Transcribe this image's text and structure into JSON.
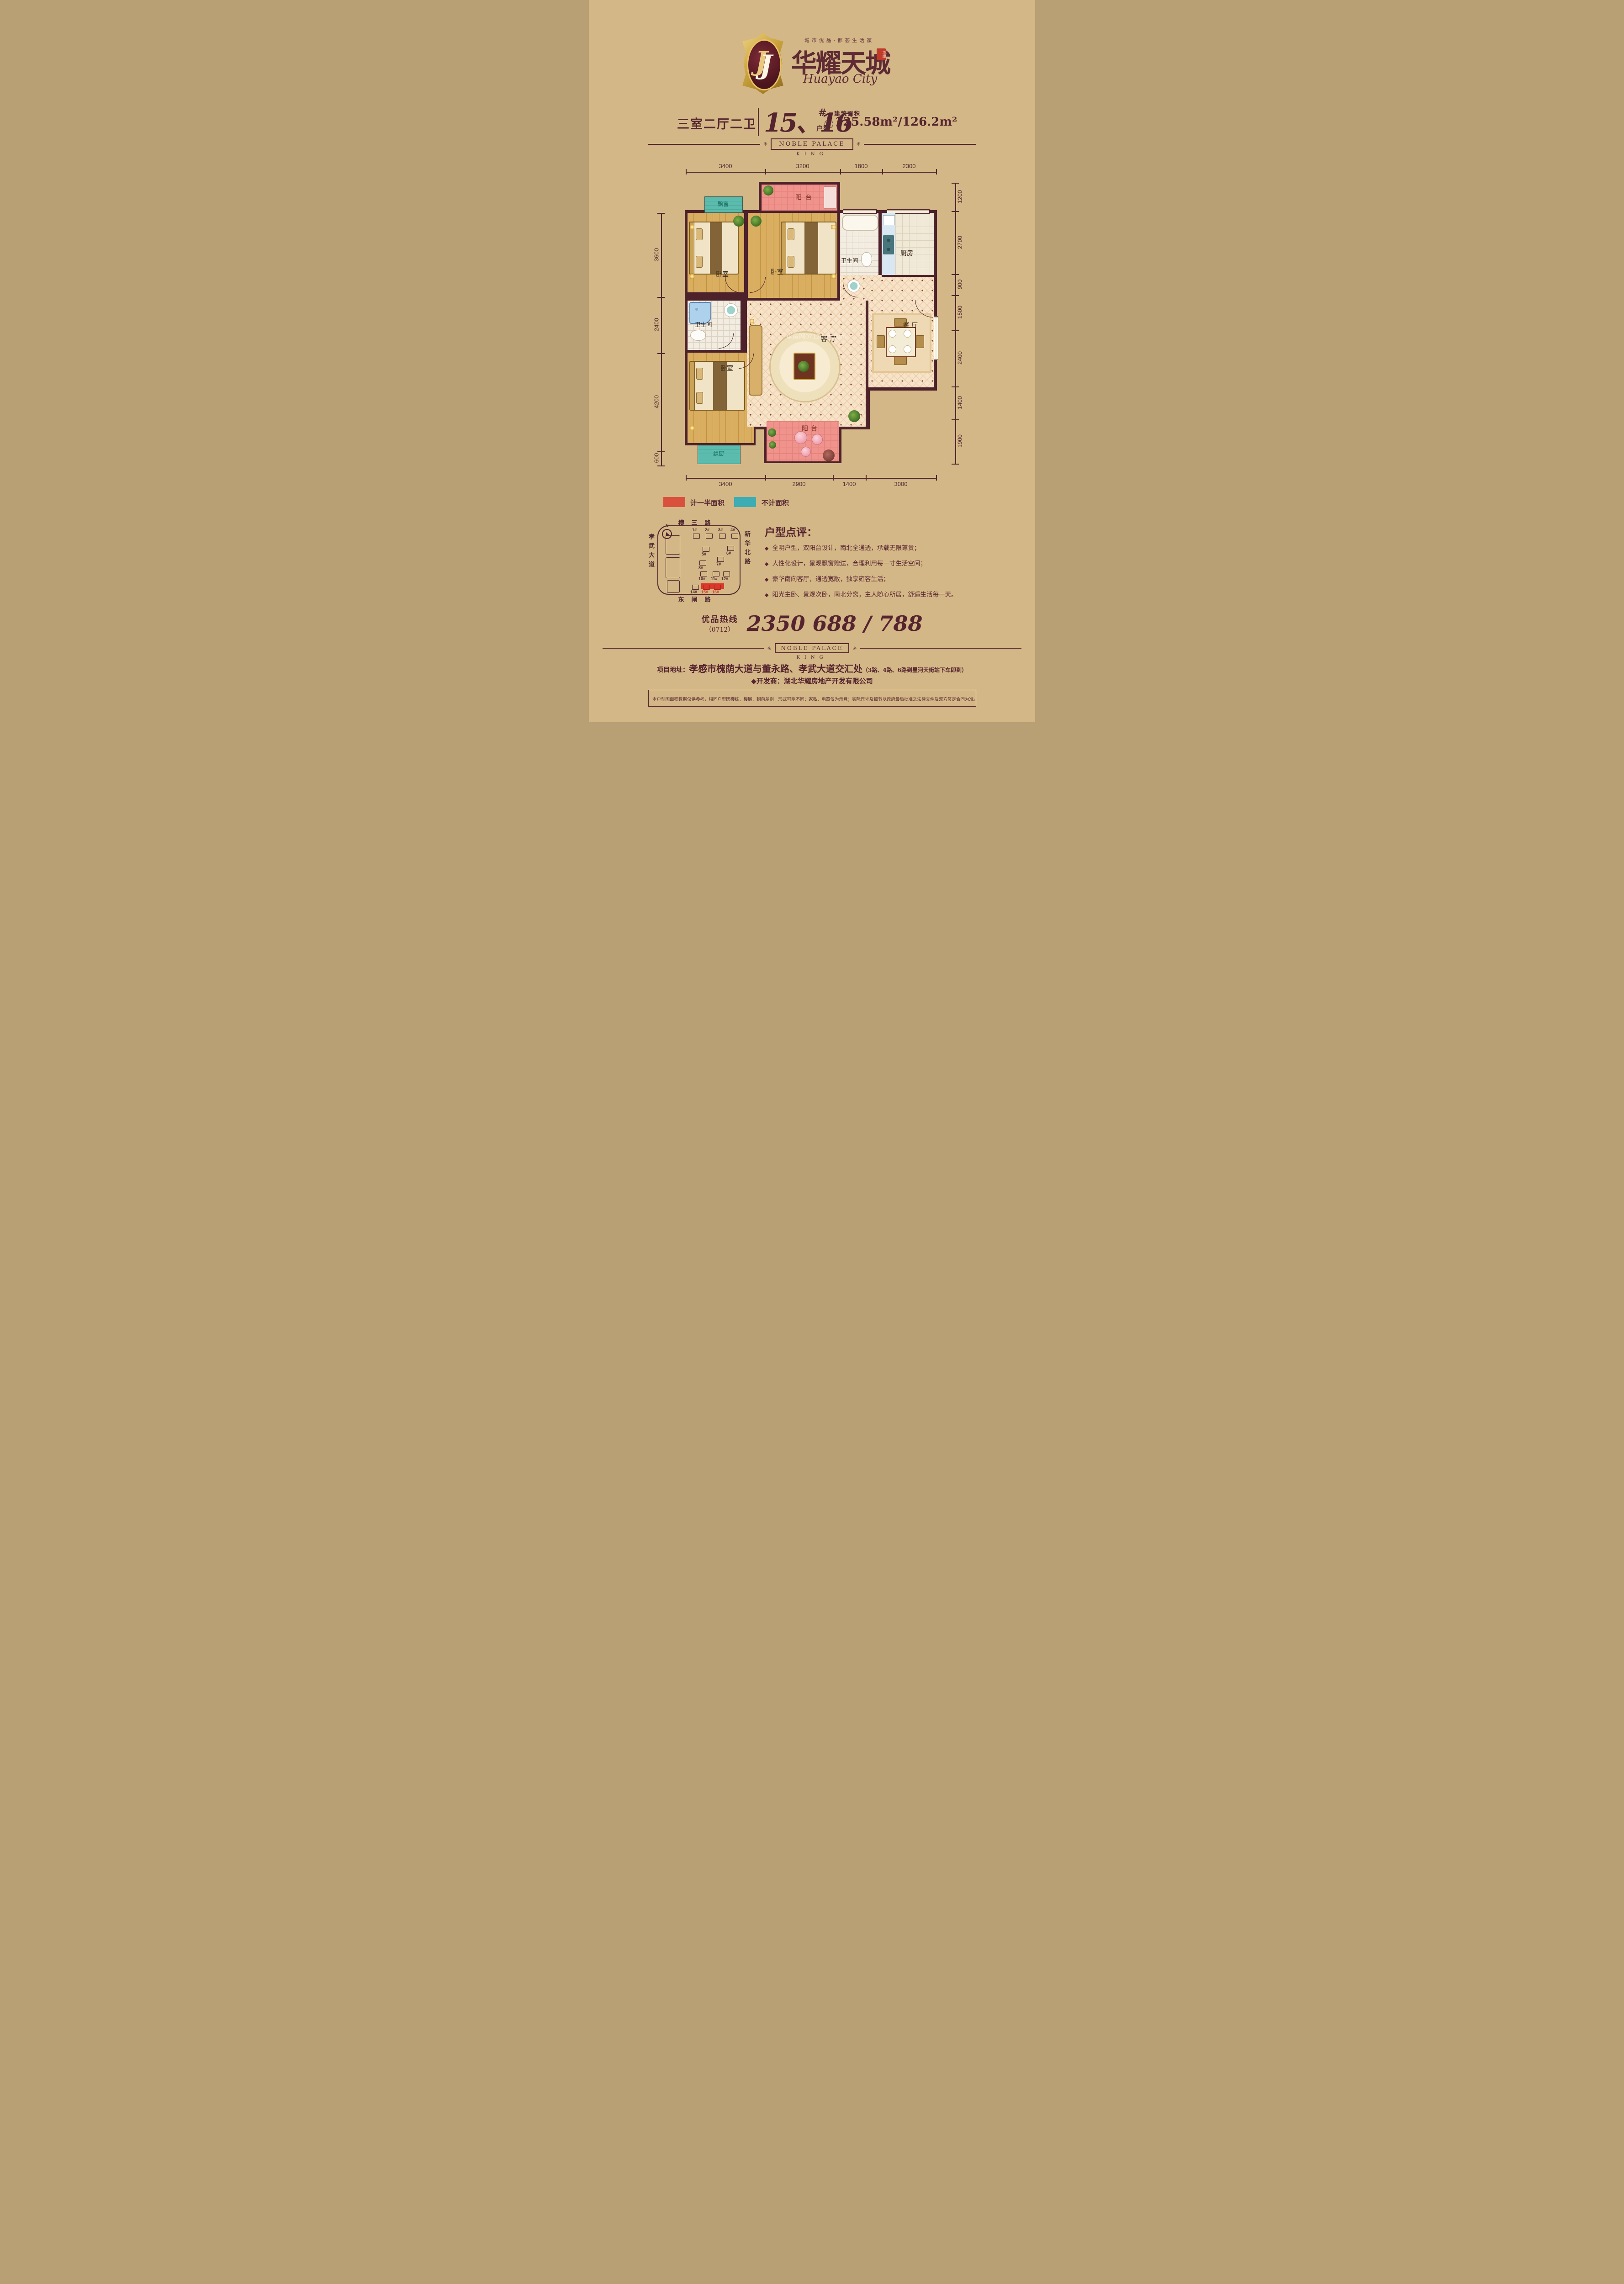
{
  "brand": {
    "tagline": "城市优品·都荟生活家",
    "name": "华耀天城",
    "name_en": "Huayao City",
    "seal_text": "华耀",
    "monogram": "J"
  },
  "title": {
    "rooms": "三室二厅二卫",
    "numbers": "15、16",
    "hash": "#",
    "unit": "户型",
    "area_label": "建筑面积",
    "approx": "约",
    "area": "125.58m²/126.2m²"
  },
  "banner": {
    "text": "NOBLE PALACE",
    "sub": "KING",
    "ornament": "✳"
  },
  "plan": {
    "watermark": "孝房网0712fang.com",
    "dims_top": [
      "3400",
      "3200",
      "1800",
      "2300"
    ],
    "dims_bottom": [
      "3400",
      "2900",
      "1400",
      "3000"
    ],
    "dims_left": [
      "3600",
      "2400",
      "4200",
      "600"
    ],
    "dims_right": [
      "1200",
      "2700",
      "900",
      "1500",
      "2400",
      "1400",
      "1900"
    ],
    "rooms": {
      "balcony": "阳台",
      "bay": "飘窗",
      "bedroom": "卧室",
      "bath": "卫生间",
      "kitchen": "厨房",
      "living": "客厅",
      "dining": "餐厅"
    }
  },
  "legend": {
    "half": {
      "label": "计一半面积",
      "color": "#d9503c"
    },
    "none": {
      "label": "不计面积",
      "color": "#3dadb4"
    }
  },
  "sitemap": {
    "compass": "N",
    "roads": {
      "top": "横三路",
      "right": "新华北路",
      "left": "孝武大道",
      "bottom": "东闸路"
    },
    "buildings": [
      "1#",
      "2#",
      "3#",
      "4#",
      "5#",
      "6#",
      "7#",
      "8#",
      "10#",
      "11#",
      "12#",
      "14#",
      "15#",
      "16#"
    ],
    "highlighted": [
      "15#",
      "16#"
    ]
  },
  "review": {
    "title": "户型点评：",
    "bullet_icon": "◆",
    "bullets": [
      "全明户型，双阳台设计，南北全通透，承载无限尊贵；",
      "人性化设计，景观飘窗赠送，合理利用每一寸生活空间；",
      "豪华南向客厅，通透宽敞，独享雍容生活；",
      "阳光主卧、景观次卧，南北分离，主人随心所居，舒适生活每一天。"
    ]
  },
  "hotline": {
    "label": "优品热线",
    "code": "（0712）",
    "number": "2350 688 / 788"
  },
  "footer": {
    "address_label": "项目地址：",
    "address": "孝感市槐荫大道与董永路、孝武大道交汇处",
    "address_note": "（3路、4路、6路到星河天街站下车即到）",
    "developer": "◆开发商：湖北华耀房地产开发有限公司",
    "disclaimer": "本户型图面积数据仅供参考，相同户型因楼栋、楼层、朝向差别，形式可能不同；家私、电器仅为示意；实际尺寸及细节以政府最后批准之法律文件及双方签定合同为准。"
  }
}
